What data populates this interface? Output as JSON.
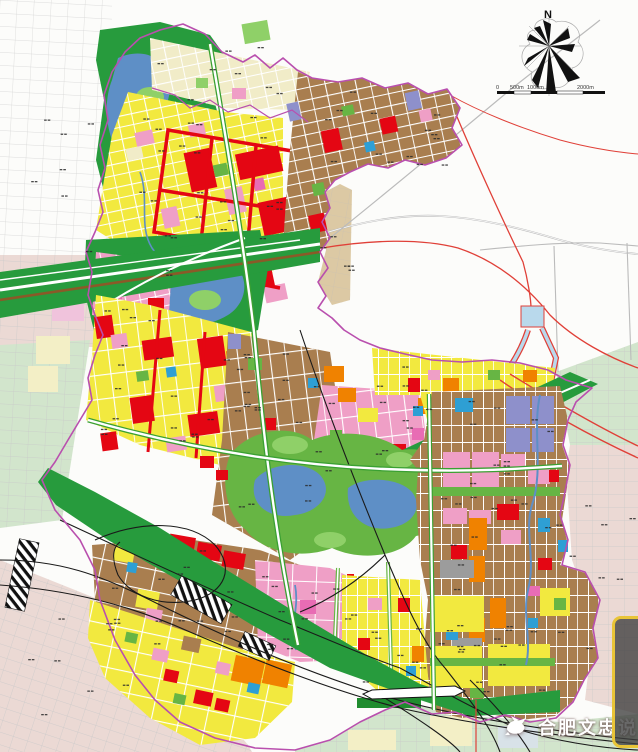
{
  "map": {
    "compass": {
      "label": "N"
    },
    "scale_bar": {
      "labels": [
        "0",
        "500m",
        "1000m",
        "2000m"
      ]
    },
    "watermark": {
      "text": "合肥文忠说",
      "icon": "dove-icon"
    },
    "overlay_panel": {
      "border_color": "#E8C437"
    },
    "palette": {
      "paper": "#FCFCFA",
      "residential_yellow": "#F2E93F",
      "village_brown": "#A97E4F",
      "commercial_red": "#E40613",
      "mixed_pink": "#EF9FC6",
      "deep_pink": "#E86CB4",
      "industrial_violet": "#8E90CB",
      "logistics_orange": "#F08200",
      "park_green": "#67B544",
      "forest_green": "#279B3D",
      "bright_green": "#8FD068",
      "water_blue": "#5E8FC6",
      "utility_blue": "#2E9FD4",
      "facility_gray": "#9C9C9C",
      "cream": "#F1ECC8",
      "tan": "#DCC9A4",
      "boundary_magenta": "#B94FAE",
      "outside_pink": "#EBD9D4",
      "outside_green": "#D2E5CC",
      "outside_yellow": "#F3EFC6",
      "road_white": "#FFFFFF",
      "rail_black": "#1A1A1A",
      "highway_brown": "#8A5A28",
      "line_red": "#E04038",
      "line_gray": "#BBBBBB",
      "canal_blue": "#B9D9EC",
      "grid_gray": "#C9C9C9",
      "mark_dark": "#2A2A2A"
    }
  }
}
